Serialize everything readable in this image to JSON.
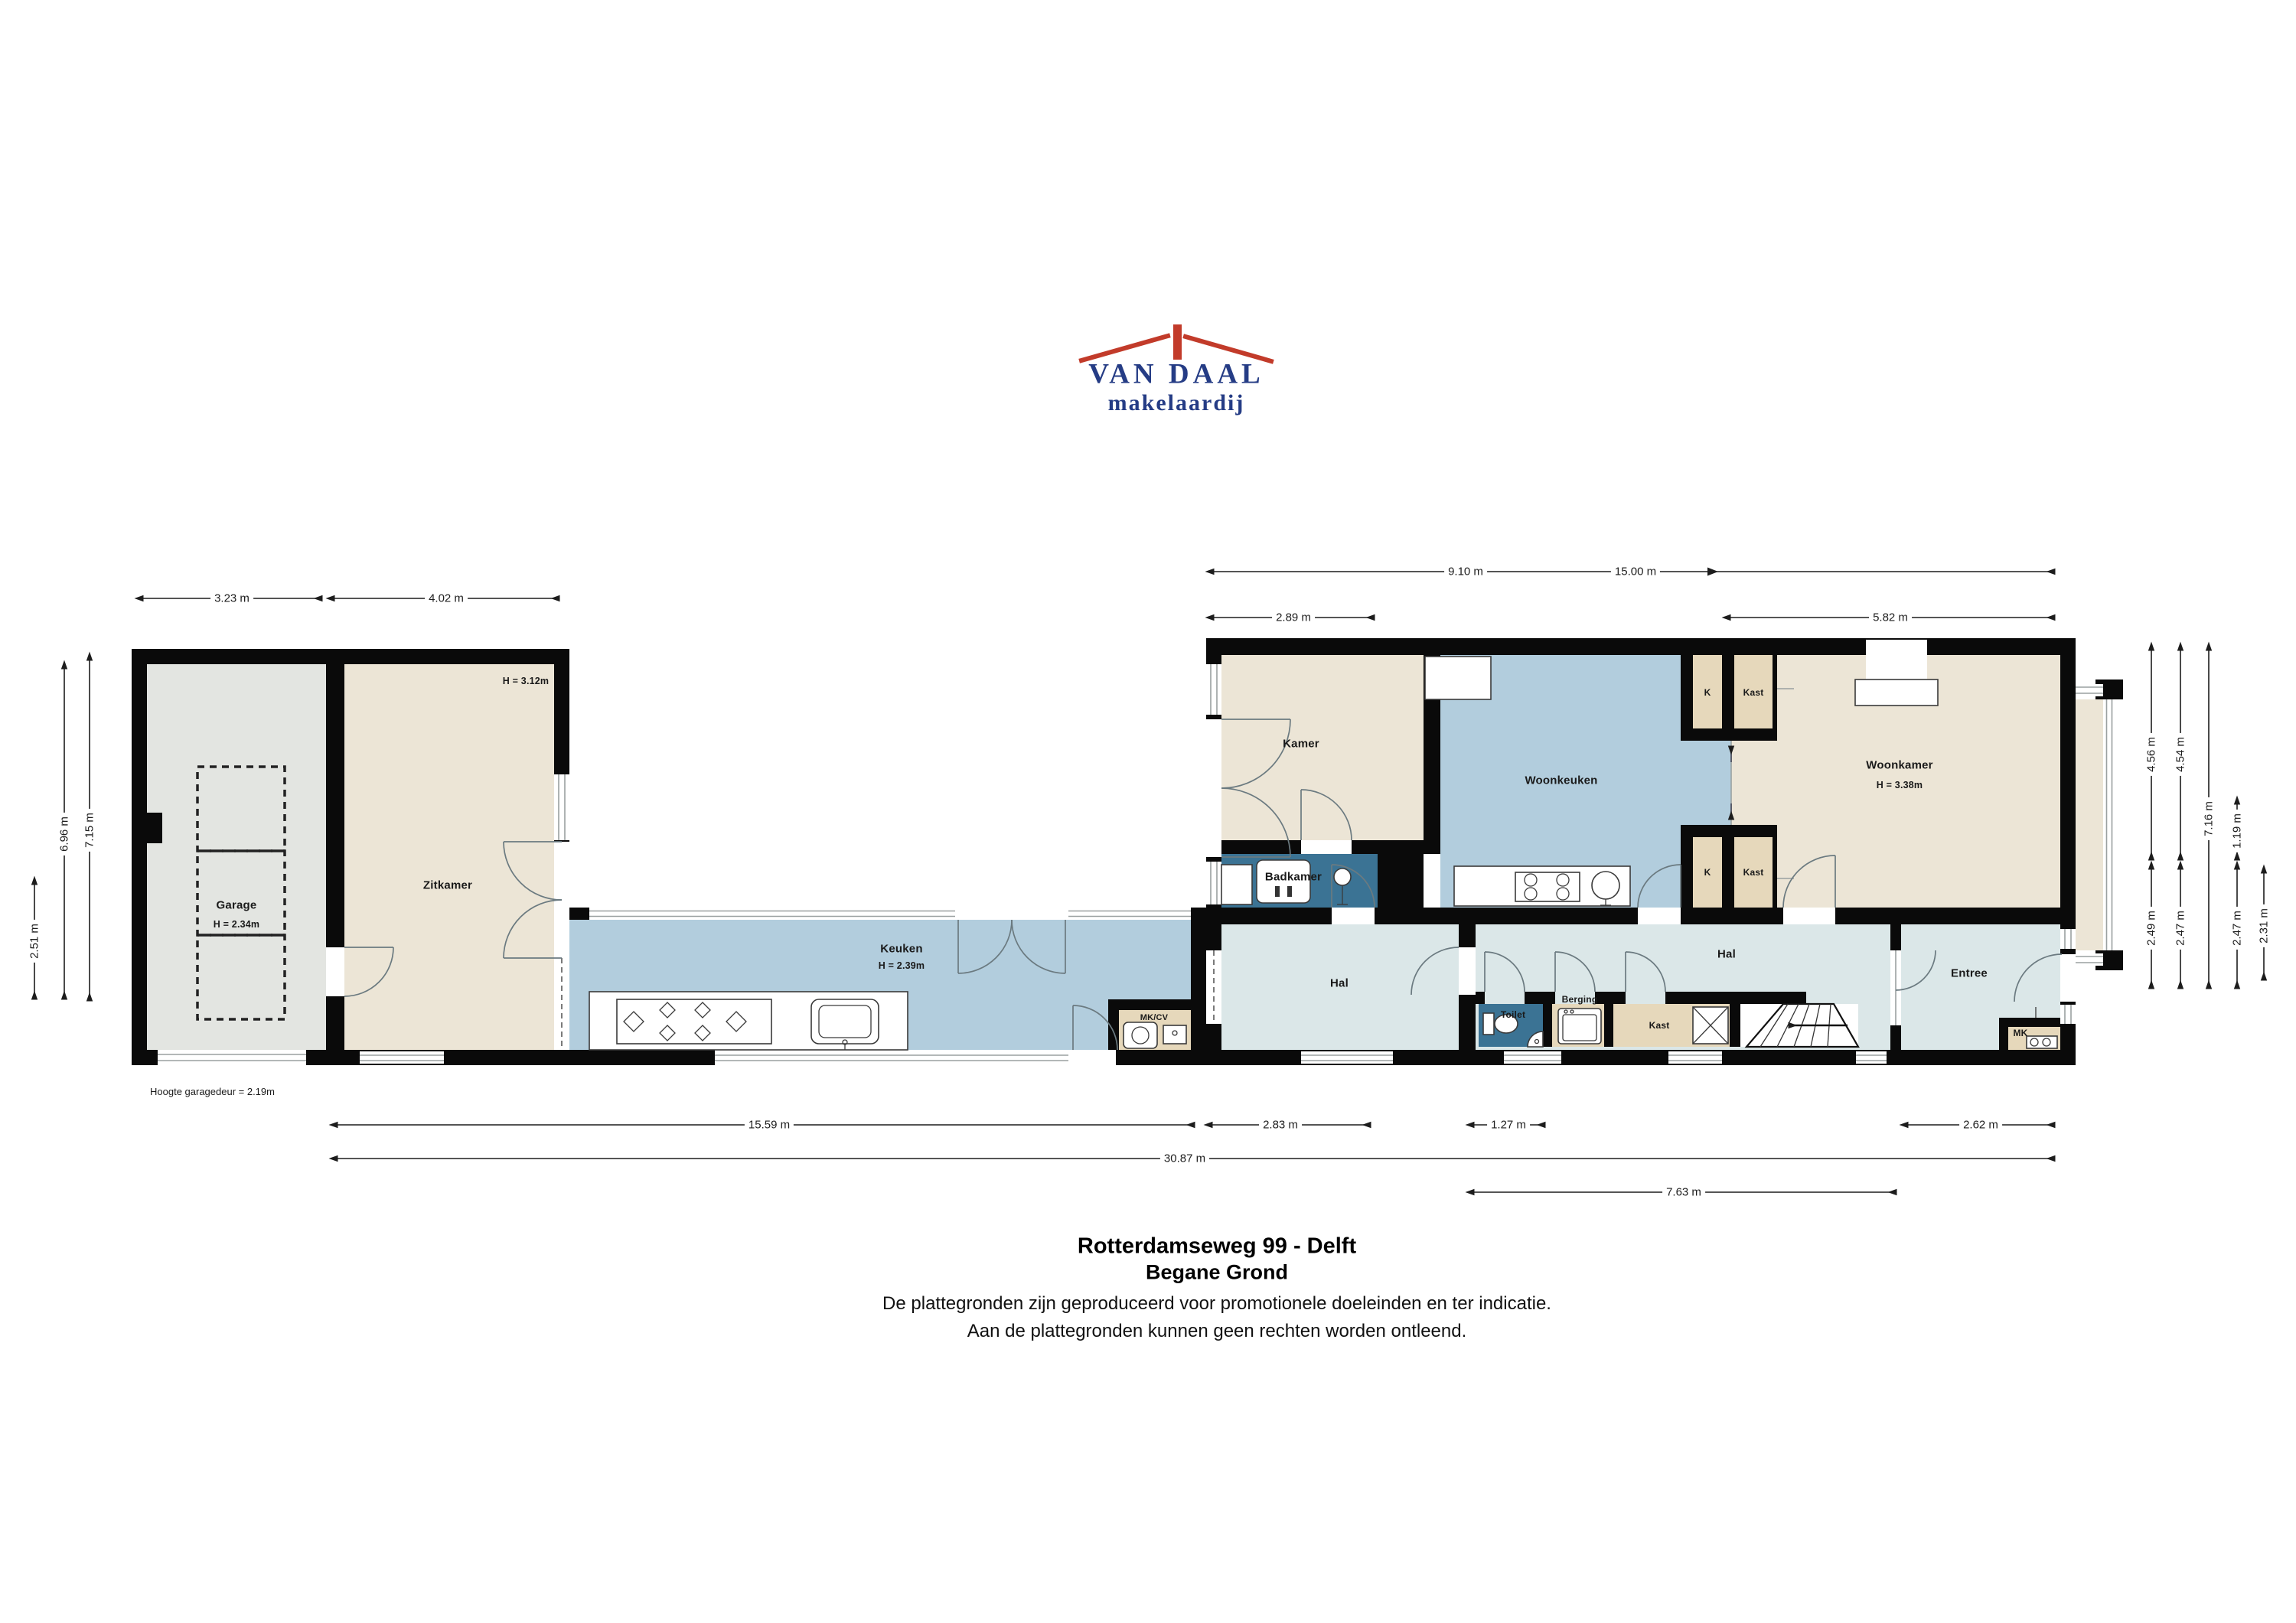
{
  "logo": {
    "name": "VAN DAAL",
    "sub": "makelaardij"
  },
  "rooms": {
    "garage": {
      "name": "Garage",
      "height": "H = 2.34m"
    },
    "zitkamer": {
      "name": "Zitkamer",
      "height": "H = 3.12m"
    },
    "keuken": {
      "name": "Keuken",
      "height": "H = 2.39m"
    },
    "kamer": {
      "name": "Kamer"
    },
    "badkamer": {
      "name": "Badkamer"
    },
    "woonkeuken": {
      "name": "Woonkeuken"
    },
    "woonkamer": {
      "name": "Woonkamer",
      "height": "H = 3.38m"
    },
    "hal_west": {
      "name": "Hal"
    },
    "hal_oost": {
      "name": "Hal"
    },
    "entree": {
      "name": "Entree"
    },
    "toilet": {
      "name": "Toilet"
    },
    "berging": {
      "name": "Berging"
    },
    "kast": {
      "name": "Kast"
    },
    "mk": {
      "name": "MK"
    },
    "mkcv": {
      "name": "MK/CV"
    },
    "koelkast_boven": {
      "name": "K"
    },
    "kast_boven": {
      "name": "Kast"
    },
    "koelkast_onder": {
      "name": "K"
    },
    "kast_onder": {
      "name": "Kast"
    }
  },
  "annotations": {
    "garagedeur": "Hoogte garagedeur = 2.19m"
  },
  "dimensions": {
    "garage_breedte": "3.23 m",
    "zitkamer_breedte": "4.02 m",
    "rechts_sub": "9.10 m",
    "rechts_totaal": "15.00 m",
    "kamer_breedte": "2.89 m",
    "woonkamer_breedte": "5.82 m",
    "links_klein": "2.51 m",
    "links_binnen": "6.96 m",
    "links_totaal": "7.15 m",
    "rechts_h1": "4.56 m",
    "rechts_h2": "4.54 m",
    "rechts_h3": "7.16 m",
    "rechts_h4": "1.19 m",
    "rechts_h5": "2.49 m",
    "rechts_h6": "2.47 m",
    "rechts_h7": "2.47 m",
    "rechts_h8": "2.31 m",
    "onder_keuken": "15.59 m",
    "onder_hal": "2.83 m",
    "onder_toilet": "1.27 m",
    "onder_entree": "2.62 m",
    "onder_totaal": "30.87 m",
    "onder_hal2": "7.63 m"
  },
  "footer": {
    "title": "Rotterdamseweg 99 - Delft",
    "subtitle": "Begane Grond",
    "disclaimer1": "De plattegronden zijn geproduceerd voor promotionele doeleinden en ter indicatie.",
    "disclaimer2": "Aan de plattegronden kunnen geen rechten worden ontleend."
  },
  "colors": {
    "wall": "#0a0a0a",
    "garage": "#e3e5e1",
    "beige": "#ece5d6",
    "tan": "#e6d8bb",
    "blue": "#b2cddd",
    "bath": "#3b7394",
    "hal": "#dbe7e8",
    "win": "#9aa0a0",
    "door": "#6b7a80",
    "dim": "#1d1d1d",
    "text": "#1a1a1a",
    "red": "#c23b2a",
    "navy": "#253c85"
  }
}
